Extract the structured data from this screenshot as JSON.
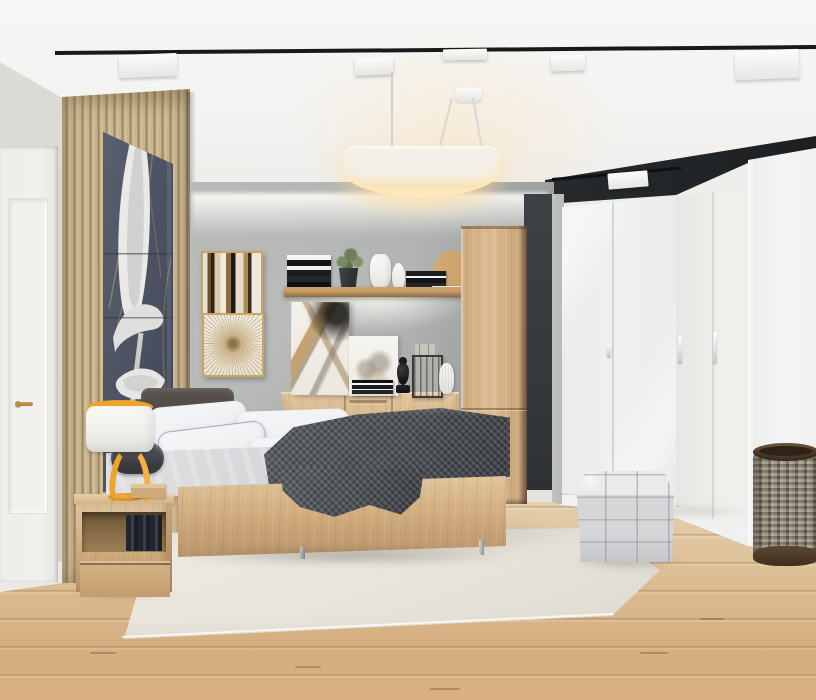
{
  "scene": {
    "title": "Modern scandinavian bedroom with oak furniture, white wardrobes and track lighting",
    "caption": "3D render of a bedroom: oak platform bed with white pillows and charcoal throw, backlit oak shelf and sideboard against a gray concrete feature wall, wood slat panel with tall botanical artwork, white entry door, round white pendant lamp, black ceiling track lights, glossy white corner wardrobe, quilted gray cube pouf, woven laundry basket, cream rug on light oak plank flooring."
  },
  "colors": {
    "ceiling": "#f6f5f3",
    "ceiling-shade": "#eae8e5",
    "track": "#17191b",
    "soffit": "#24272a",
    "wall-left": "#d9d7d2",
    "door": "#f1f0ec",
    "brass": "#bb9148",
    "slat-light": "#cfbc97",
    "slat-dark": "#8e7b58",
    "art-bg": "#525869",
    "art-flower": "#e9e9e6",
    "accent-wall": "#b2b4b3",
    "dark-panel": "#35383c",
    "concrete": "#b7b9b8",
    "wardrobe": "#eef0f1",
    "wardrobe-side": "#f3f4f3",
    "oak": "#d2ae80",
    "oak-light": "#e2c79f",
    "oak-dark": "#b9946a",
    "frame-gold": "#c8a766",
    "pillow": "#eef0f2",
    "duvet": "#d4d5d8",
    "blanket": "#4e5156",
    "headboard": "#4b463f",
    "lamp-yellow": "#eda42d",
    "rug": "#e8e4db",
    "floor-light": "#e7d4b3",
    "floor-dark": "#d5ae80",
    "pouf": "#d4d6d8",
    "basket-dark": "#54412c",
    "basket-weave": "#97907f",
    "glow-warm": "#ffe3a8"
  },
  "objects": [
    {
      "name": "ceiling-track-lighting",
      "label": "Black track rail with white spotlight heads"
    },
    {
      "name": "pendant-lamp",
      "label": "Round white drum pendant lamp, lit warm"
    },
    {
      "name": "entry-door",
      "label": "White interior door with brass handle"
    },
    {
      "name": "slat-accent-wall",
      "label": "Vertical wood slat panel"
    },
    {
      "name": "botanical-artwork",
      "label": "Tall botanical print, white calla lilies on dark navy"
    },
    {
      "name": "framed-art-abstract",
      "label": "Gold-framed abstract painting in earth tones"
    },
    {
      "name": "framed-art-starburst",
      "label": "Gold-framed starburst print on cream"
    },
    {
      "name": "accent-wall",
      "label": "Gray concrete feature wall with cove lighting"
    },
    {
      "name": "wall-shelf",
      "label": "Backlit oak wall shelf with books, vases, plant and wooden arch"
    },
    {
      "name": "dresser",
      "label": "Oak sideboard with two doors and center drawers"
    },
    {
      "name": "leaning-canvases",
      "label": "Two leaning art canvases on the sideboard"
    },
    {
      "name": "decor-objects",
      "label": "Book stack, black finial, bottle crate and white vase"
    },
    {
      "name": "tall-cabinet",
      "label": "Tall oak wardrobe cabinet"
    },
    {
      "name": "bed",
      "label": "Oak platform bed with white pillows, gray duvet and charcoal throw"
    },
    {
      "name": "nightstand",
      "label": "Oak nightstand with open shelf, books and storage box"
    },
    {
      "name": "table-lamp",
      "label": "Yellow sculptural table lamp with white drum shade"
    },
    {
      "name": "rug",
      "label": "Cream area rug"
    },
    {
      "name": "wood-floor",
      "label": "Light washed-oak plank flooring"
    },
    {
      "name": "white-wardrobe",
      "label": "Glossy white corner wardrobe with bar handles"
    },
    {
      "name": "pouf",
      "label": "Quilted light-gray cube pouf"
    },
    {
      "name": "wicker-basket",
      "label": "Round woven laundry basket with dark rims"
    }
  ]
}
